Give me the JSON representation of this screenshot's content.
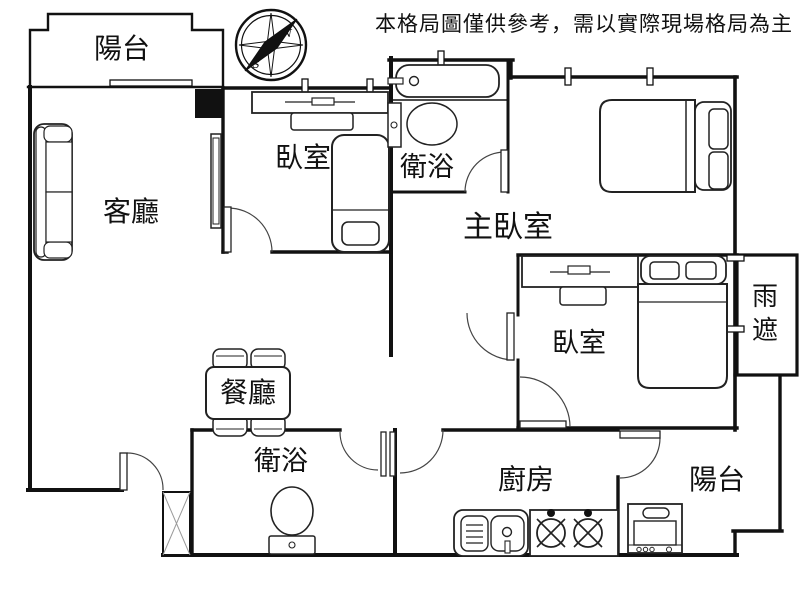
{
  "disclaimer": "本格局圖僅供參考，需以實際現場格局為主",
  "compass": {
    "north": "N",
    "south": "S"
  },
  "rooms": {
    "balcony_top": "陽台",
    "living": "客廳",
    "bedroom_top": "臥室",
    "bathroom_top": "衛浴",
    "master_bedroom": "主臥室",
    "bedroom_right": "臥室",
    "dining": "餐廳",
    "bathroom_bottom": "衛浴",
    "kitchen": "廚房",
    "balcony_bottom": "陽台",
    "rain_shelter_char_1": "雨",
    "rain_shelter_char_2": "遮"
  },
  "colors": {
    "wall": "#111111",
    "disclaimer_red": "#c00000",
    "background": "#ffffff"
  }
}
